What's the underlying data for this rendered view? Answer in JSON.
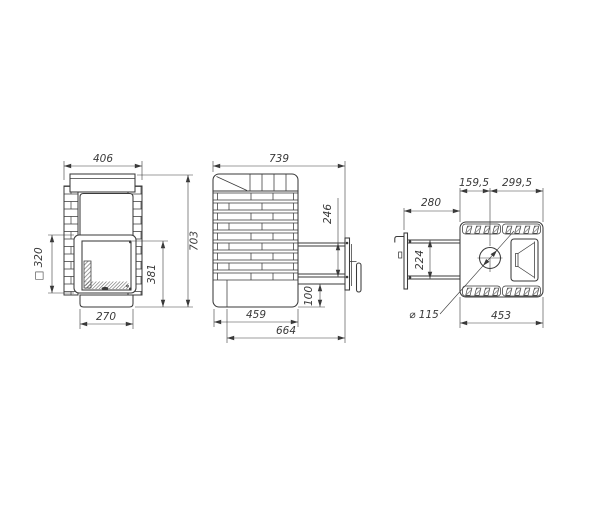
{
  "drawing": {
    "type": "technical-orthographic-views",
    "views": {
      "front": {
        "dims": {
          "overall_width": "406",
          "overall_height": "703",
          "firebox_door_height": "381",
          "door_square": "□ 320",
          "base_width": "270"
        }
      },
      "side": {
        "dims": {
          "overall_depth": "739",
          "tunnel_opening_height": "246",
          "tunnel_bottom_offset": "100",
          "body_depth": "459",
          "depth_with_tunnel": "664"
        }
      },
      "top": {
        "dims": {
          "tunnel_length": "280",
          "front_to_chimney": "159,5",
          "chimney_to_rear": "299,5",
          "tunnel_width": "224",
          "body_width": "453",
          "chimney_diameter": "⌀ 115"
        }
      }
    },
    "colors": {
      "line": "#3a3a3a",
      "background": "#ffffff"
    }
  }
}
